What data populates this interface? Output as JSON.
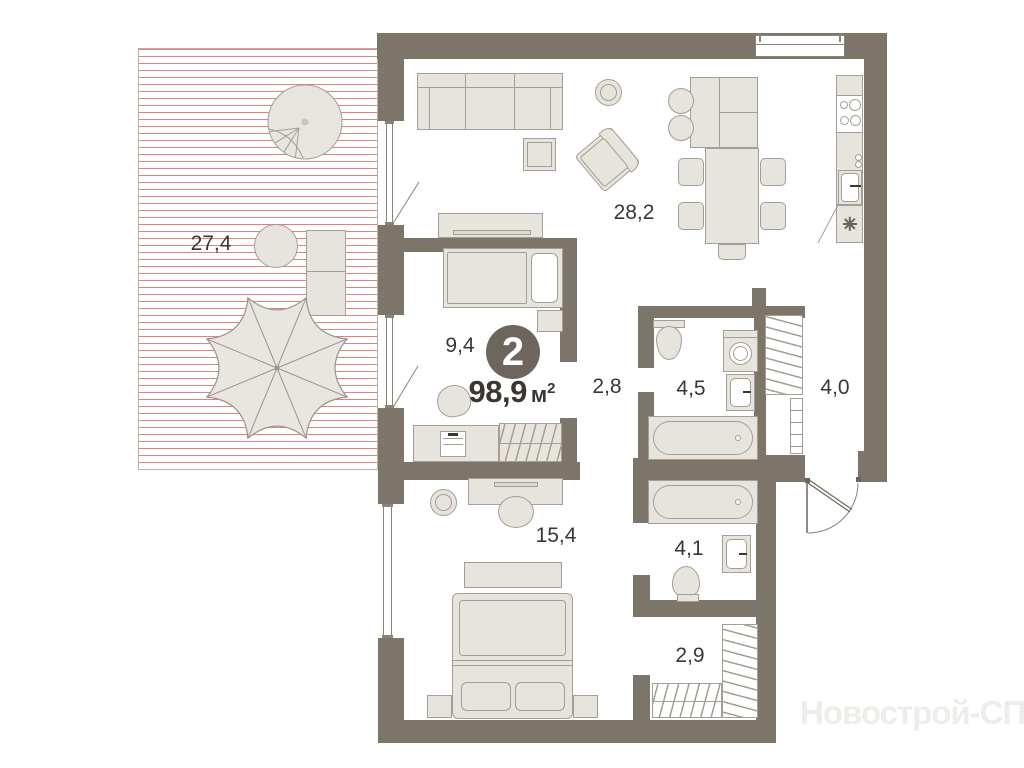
{
  "colors": {
    "wall": "#7d7569",
    "furn_fill": "#e7e4de",
    "furn_line": "#a49e94",
    "ink": "#3a3733",
    "hatch": "#e2837a",
    "terrace_line": "#b7b1a9",
    "badge_bg": "#6e665c",
    "badge_text": "#ffffff",
    "watermark": "#efedea",
    "thin_line": "#8a8378"
  },
  "plan": {
    "badge": {
      "rooms_count": "2",
      "area_value": "98,9",
      "area_unit": "м",
      "area_superscript": "2"
    },
    "rooms": [
      {
        "name": "terrace",
        "area": "27,4"
      },
      {
        "name": "living-kitchen",
        "area": "28,2"
      },
      {
        "name": "bedroom",
        "area": "9,4"
      },
      {
        "name": "hallway",
        "area": "2,8"
      },
      {
        "name": "bathroom",
        "area": "4,5"
      },
      {
        "name": "entry-hall",
        "area": "4,0"
      },
      {
        "name": "master-bedroom",
        "area": "15,4"
      },
      {
        "name": "master-bathroom",
        "area": "4,1"
      },
      {
        "name": "walk-in-closet",
        "area": "2,9"
      }
    ],
    "watermark": "Новострой-СПб"
  }
}
